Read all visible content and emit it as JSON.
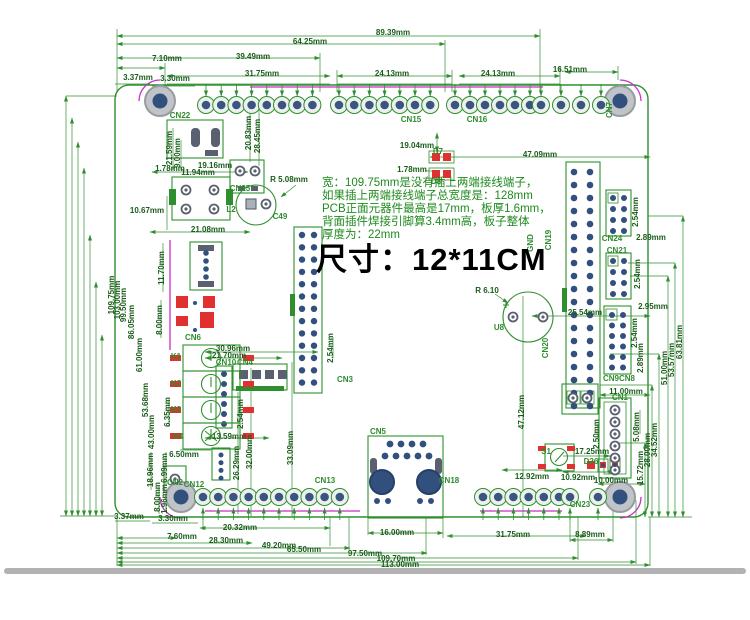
{
  "size_label": "尺寸：12*11CM",
  "notes": {
    "line1": "宽：109.75mm是没有插上两端接线端子，",
    "line2": "如果插上两端接线端子总宽度是：128mm",
    "line3": "PCB正面元器件最高是17mm，板厚1.6mm，",
    "line4": "背面插件焊接引脚算3.4mm高，板子整体",
    "line5": "厚度为：22mm"
  },
  "colors": {
    "dimension_line": "#2f8f2f",
    "dimension_text": "#1a5c1a",
    "component_text": "#2e8b2e",
    "note_text": "#1e8a1e",
    "size_text": "#000000",
    "pad_inner": "#3a5680",
    "component_red": "#e03030",
    "corner_arc_magenta": "#c92fc9",
    "separator_gray": "#b2b2b2"
  },
  "dim_labels": [
    {
      "text": "89.39mm",
      "x": 393,
      "y": 33
    },
    {
      "text": "64.25mm",
      "x": 310,
      "y": 42
    },
    {
      "text": "39.49mm",
      "x": 253,
      "y": 57
    },
    {
      "text": "7.10mm",
      "x": 167,
      "y": 59
    },
    {
      "text": "31.75mm",
      "x": 262,
      "y": 74
    },
    {
      "text": "24.13mm",
      "x": 392,
      "y": 74
    },
    {
      "text": "24.13mm",
      "x": 498,
      "y": 74
    },
    {
      "text": "16.51mm",
      "x": 570,
      "y": 70
    },
    {
      "text": "3.37mm",
      "x": 138,
      "y": 78
    },
    {
      "text": "3.30mm",
      "x": 175,
      "y": 79
    },
    {
      "text": "109.75mm",
      "x": 112,
      "y": 295,
      "rot": true
    },
    {
      "text": "103.00mm",
      "x": 118,
      "y": 300,
      "rot": true
    },
    {
      "text": "99.50mm",
      "x": 124,
      "y": 305,
      "rot": true
    },
    {
      "text": "86.05mm",
      "x": 132,
      "y": 322,
      "rot": true
    },
    {
      "text": "61.00mm",
      "x": 140,
      "y": 355,
      "rot": true
    },
    {
      "text": "53.68mm",
      "x": 146,
      "y": 400,
      "rot": true
    },
    {
      "text": "43.00mm",
      "x": 152,
      "y": 432,
      "rot": true
    },
    {
      "text": "21.59mm",
      "x": 170,
      "y": 148,
      "rot": true
    },
    {
      "text": "9.00mm",
      "x": 178,
      "y": 153,
      "rot": true
    },
    {
      "text": "20.83mm",
      "x": 249,
      "y": 133,
      "rot": true
    },
    {
      "text": "28.45mm",
      "x": 258,
      "y": 136,
      "rot": true
    },
    {
      "text": "1.78mm",
      "x": 170,
      "y": 169
    },
    {
      "text": "19.16mm",
      "x": 215,
      "y": 166
    },
    {
      "text": "11.94mm",
      "x": 198,
      "y": 173
    },
    {
      "text": "10.67mm",
      "x": 147,
      "y": 211
    },
    {
      "text": "21.08mm",
      "x": 208,
      "y": 230
    },
    {
      "text": "R 5.08mm",
      "x": 289,
      "y": 180
    },
    {
      "text": "19.04mm",
      "x": 417,
      "y": 146
    },
    {
      "text": "1.78mm",
      "x": 412,
      "y": 170
    },
    {
      "text": "47.09mm",
      "x": 540,
      "y": 155
    },
    {
      "text": "11.70mm",
      "x": 162,
      "y": 268,
      "rot": true
    },
    {
      "text": "8.00mm",
      "x": 160,
      "y": 320,
      "rot": true
    },
    {
      "text": "6.35mm",
      "x": 168,
      "y": 412,
      "rot": true
    },
    {
      "text": "6.50mm",
      "x": 184,
      "y": 455
    },
    {
      "text": "6.99mm",
      "x": 165,
      "y": 468,
      "rot": true
    },
    {
      "text": "18.96mm",
      "x": 151,
      "y": 470,
      "rot": true
    },
    {
      "text": "8.00mm",
      "x": 158,
      "y": 497,
      "rot": true
    },
    {
      "text": "1.96mm",
      "x": 165,
      "y": 499,
      "rot": true
    },
    {
      "text": "26.29mm",
      "x": 237,
      "y": 463,
      "rot": true
    },
    {
      "text": "13.59mm",
      "x": 229,
      "y": 437
    },
    {
      "text": "30.96mm",
      "x": 233,
      "y": 349
    },
    {
      "text": "21.70mm",
      "x": 229,
      "y": 356
    },
    {
      "text": "2.54mm",
      "x": 241,
      "y": 414,
      "rot": true
    },
    {
      "text": "32.00mm",
      "x": 250,
      "y": 452,
      "rot": true
    },
    {
      "text": "33.09mm",
      "x": 291,
      "y": 448,
      "rot": true
    },
    {
      "text": "2.54mm",
      "x": 331,
      "y": 348,
      "rot": true
    },
    {
      "text": "25.54mm",
      "x": 585,
      "y": 313
    },
    {
      "text": "R 6.10",
      "x": 487,
      "y": 291
    },
    {
      "text": "47.12mm",
      "x": 522,
      "y": 412,
      "rot": true
    },
    {
      "text": "2.54mm",
      "x": 636,
      "y": 212,
      "rot": true
    },
    {
      "text": "2.89mm",
      "x": 651,
      "y": 238
    },
    {
      "text": "2.54mm",
      "x": 638,
      "y": 274,
      "rot": true
    },
    {
      "text": "2.95mm",
      "x": 653,
      "y": 307
    },
    {
      "text": "2.54mm",
      "x": 635,
      "y": 333,
      "rot": true
    },
    {
      "text": "2.89mm",
      "x": 641,
      "y": 358,
      "rot": true
    },
    {
      "text": "11.00mm",
      "x": 626,
      "y": 392
    },
    {
      "text": "2.50mm",
      "x": 597,
      "y": 434,
      "rot": true
    },
    {
      "text": "5.08mm",
      "x": 637,
      "y": 427,
      "rot": true
    },
    {
      "text": "17.25mm",
      "x": 592,
      "y": 452
    },
    {
      "text": "12.92mm",
      "x": 532,
      "y": 477
    },
    {
      "text": "10.92mm",
      "x": 578,
      "y": 478
    },
    {
      "text": "10.00mm",
      "x": 611,
      "y": 481
    },
    {
      "text": "15.72mm",
      "x": 641,
      "y": 468,
      "rot": true
    },
    {
      "text": "28.00mm",
      "x": 648,
      "y": 450,
      "rot": true
    },
    {
      "text": "34.52mm",
      "x": 655,
      "y": 440,
      "rot": true
    },
    {
      "text": "51.00mm",
      "x": 665,
      "y": 368,
      "rot": true
    },
    {
      "text": "53.57mm",
      "x": 672,
      "y": 360,
      "rot": true
    },
    {
      "text": "63.81mm",
      "x": 680,
      "y": 342,
      "rot": true
    },
    {
      "text": "3.37mm",
      "x": 129,
      "y": 517
    },
    {
      "text": "3.30mm",
      "x": 173,
      "y": 519
    },
    {
      "text": "20.32mm",
      "x": 240,
      "y": 528
    },
    {
      "text": "7.60mm",
      "x": 182,
      "y": 537
    },
    {
      "text": "28.30mm",
      "x": 226,
      "y": 541
    },
    {
      "text": "49.20mm",
      "x": 279,
      "y": 546
    },
    {
      "text": "65.50mm",
      "x": 304,
      "y": 550
    },
    {
      "text": "16.00mm",
      "x": 397,
      "y": 533
    },
    {
      "text": "31.75mm",
      "x": 513,
      "y": 535
    },
    {
      "text": "8.89mm",
      "x": 590,
      "y": 535
    },
    {
      "text": "97.50mm",
      "x": 365,
      "y": 554
    },
    {
      "text": "109.70mm",
      "x": 396,
      "y": 559
    },
    {
      "text": "113.00mm",
      "x": 400,
      "y": 565
    }
  ],
  "component_labels": [
    {
      "text": "CN22",
      "x": 180,
      "y": 116
    },
    {
      "text": "CN25",
      "x": 240,
      "y": 189
    },
    {
      "text": "L2",
      "x": 231,
      "y": 210
    },
    {
      "text": "C49",
      "x": 280,
      "y": 217
    },
    {
      "text": "CN15",
      "x": 411,
      "y": 120
    },
    {
      "text": "CN16",
      "x": 477,
      "y": 120
    },
    {
      "text": "CN7",
      "x": 610,
      "y": 110,
      "rot": true
    },
    {
      "text": "D7",
      "x": 438,
      "y": 152
    },
    {
      "text": "D8",
      "x": 436,
      "y": 182
    },
    {
      "text": "GND",
      "x": 531,
      "y": 243,
      "rot": true
    },
    {
      "text": "CN19",
      "x": 549,
      "y": 240,
      "rot": true
    },
    {
      "text": "CN24",
      "x": 612,
      "y": 239
    },
    {
      "text": "CN21",
      "x": 617,
      "y": 251
    },
    {
      "text": "CN9",
      "x": 611,
      "y": 379
    },
    {
      "text": "CN8",
      "x": 627,
      "y": 379
    },
    {
      "text": "CN1",
      "x": 620,
      "y": 398
    },
    {
      "text": "U8",
      "x": 499,
      "y": 328
    },
    {
      "text": "CN20",
      "x": 546,
      "y": 348,
      "rot": true
    },
    {
      "text": "CN3",
      "x": 345,
      "y": 380
    },
    {
      "text": "CN5",
      "x": 378,
      "y": 432
    },
    {
      "text": "CN13",
      "x": 325,
      "y": 481
    },
    {
      "text": "CN18",
      "x": 449,
      "y": 481
    },
    {
      "text": "CN23",
      "x": 580,
      "y": 505
    },
    {
      "text": "CN2",
      "x": 175,
      "y": 483
    },
    {
      "text": "CN12",
      "x": 194,
      "y": 485
    },
    {
      "text": "CN6",
      "x": 193,
      "y": 338
    },
    {
      "text": "CN10",
      "x": 226,
      "y": 363
    },
    {
      "text": "CN4",
      "x": 245,
      "y": 363
    },
    {
      "text": "K1",
      "x": 176,
      "y": 357
    },
    {
      "text": "K2",
      "x": 176,
      "y": 384
    },
    {
      "text": "K3",
      "x": 176,
      "y": 410
    },
    {
      "text": "K4",
      "x": 178,
      "y": 437
    },
    {
      "text": "S1",
      "x": 546,
      "y": 452
    },
    {
      "text": "D26",
      "x": 591,
      "y": 462
    }
  ]
}
